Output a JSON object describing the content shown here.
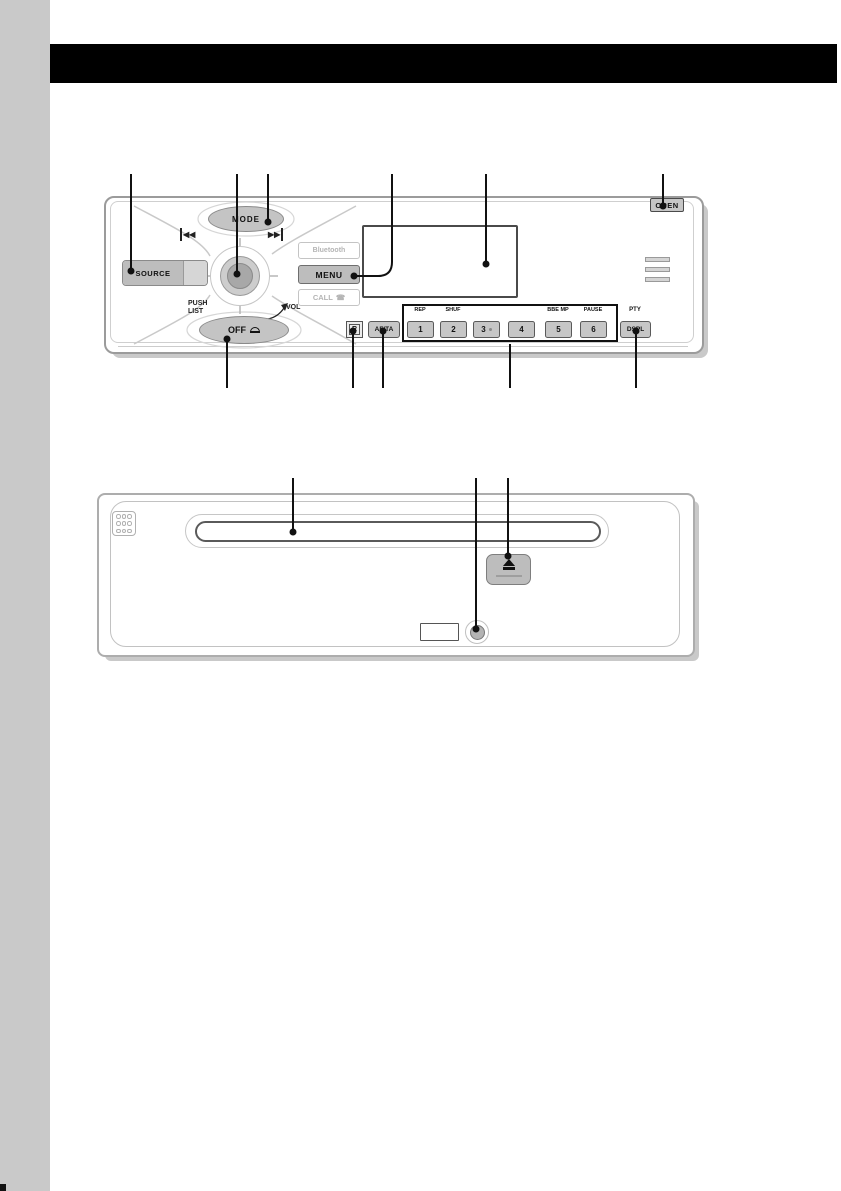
{
  "colors": {
    "sidebar": "#c9c9c9",
    "header_bar": "#000000",
    "button_gray": "#c6c6c6",
    "plate_outline": "#9b9b9b",
    "disabled_text": "#b5b5b5",
    "callout": "#111111"
  },
  "unit1": {
    "open_label": "OPEN",
    "mode_label": "MODE",
    "source_label": "SOURCE",
    "bluetooth_label": "Bluetooth",
    "menu_label": "MENU",
    "call_label": "CALL",
    "push_label": "PUSH",
    "list_label": "LIST",
    "vol_label": "VOL",
    "off_label": "OFF",
    "remote_sensor_label": "R",
    "afta_label": "AF/TA",
    "pty_label": "PTY",
    "dspl_label": "DSPL",
    "presets": [
      {
        "num": "1",
        "label": "REP"
      },
      {
        "num": "2",
        "label": "SHUF"
      },
      {
        "num": "3",
        "label": ""
      },
      {
        "num": "4",
        "label": ""
      },
      {
        "num": "5",
        "label": "BBE MP"
      },
      {
        "num": "6",
        "label": "PAUSE"
      }
    ]
  },
  "icons": {
    "seek_back": "◀◀",
    "seek_forward": "▶▶",
    "call_phone": "☎",
    "eject": "eject-triangle"
  }
}
